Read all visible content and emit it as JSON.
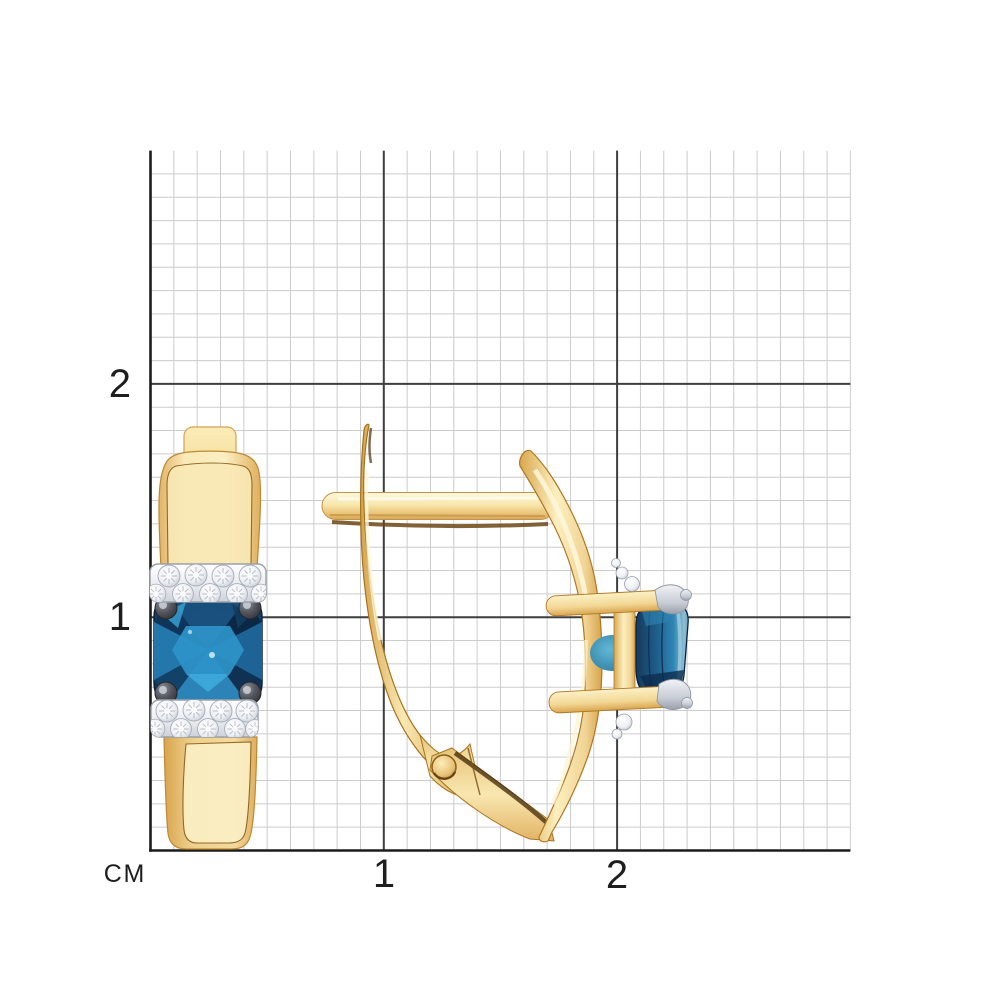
{
  "page": {
    "background": "#ffffff"
  },
  "ruler": {
    "unit_label": "СМ",
    "x_ticks": [
      {
        "value": 1,
        "label": "1"
      },
      {
        "value": 2,
        "label": "2"
      }
    ],
    "y_ticks": [
      {
        "value": 1,
        "label": "1"
      },
      {
        "value": 2,
        "label": "2"
      }
    ],
    "grid": {
      "x0": 150.5,
      "y_bottom": 850.5,
      "cell_px": 23.33,
      "cells": 30,
      "major_every": 10,
      "minor_color": "#cccccc",
      "major_color": "#3e3e3e",
      "axis_color": "#1c1c1c"
    }
  },
  "product": {
    "views": [
      {
        "name": "front-view-earring"
      },
      {
        "name": "side-view-earring"
      }
    ],
    "colors": {
      "gold_light": "#FBEFC2",
      "gold_mid": "#EFCB82",
      "gold_deep": "#D8A34E",
      "gold_outline": "#B07722",
      "gold_shadow": "#5F3A0C",
      "stone_blue": "#1D5E8F",
      "stone_blue_dark": "#0C2A47",
      "stone_cyan": "#3EA8DB",
      "diamond_white": "#F7F9FB",
      "white_gold": "#C9CED6",
      "prong_dark": "#43454C"
    }
  }
}
